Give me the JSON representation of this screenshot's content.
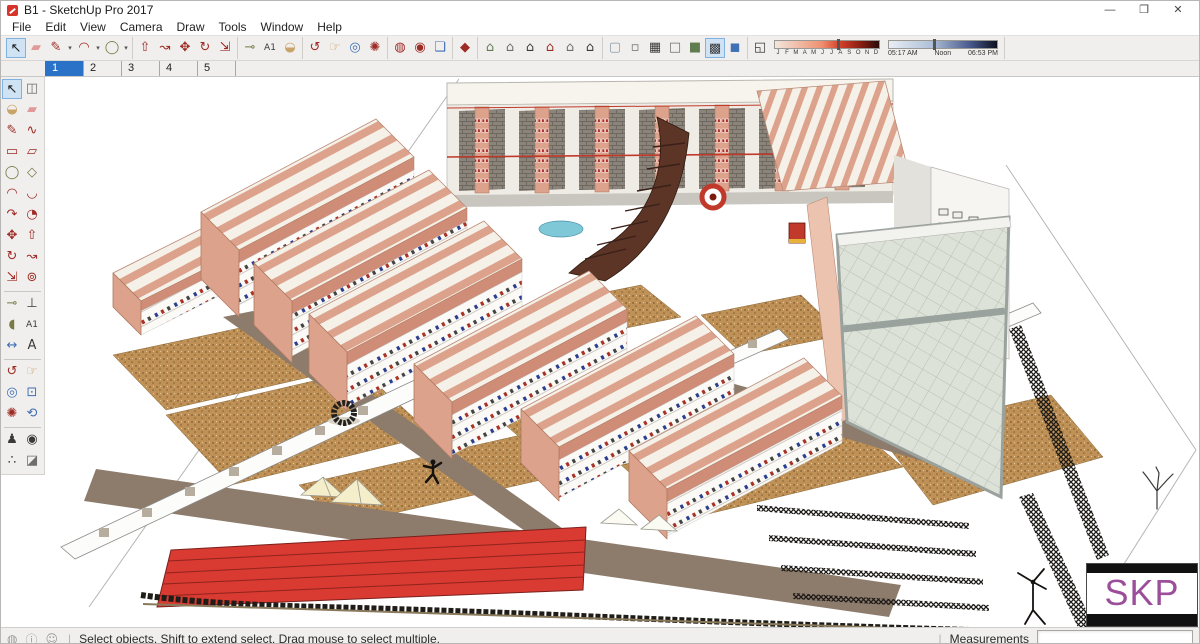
{
  "window": {
    "title": "B1 - SketchUp Pro 2017"
  },
  "menu": {
    "items": [
      "File",
      "Edit",
      "View",
      "Camera",
      "Draw",
      "Tools",
      "Window",
      "Help"
    ]
  },
  "icons": {
    "minimize": "—",
    "restore": "❐",
    "close": "✕",
    "dropdown": "▾",
    "select": "↖",
    "make_component": "◫",
    "paint_bucket": "◒",
    "eraser": "▰",
    "line": "✎",
    "freehand": "∿",
    "rectangle": "▭",
    "rotated_rectangle": "▱",
    "circle": "◯",
    "polygon": "◇",
    "arc": "◠",
    "arc2": "◡",
    "arc3": "↷",
    "pie": "◔",
    "move": "✥",
    "push_pull": "⇧",
    "rotate": "↻",
    "follow_me": "↝",
    "scale": "⇲",
    "offset": "⊚",
    "tape": "⊸",
    "axes": "⊥",
    "protractor": "◖",
    "text": "A1",
    "dimension": "↔",
    "text3d": "A",
    "orbit": "↺",
    "pan": "☞",
    "zoom": "◎",
    "zoom_window": "⊡",
    "zoom_extents": "✺",
    "previous": "⟲",
    "position_camera": "♟",
    "look_around": "◉",
    "walk": "∴",
    "section": "◪",
    "add_location": "◍",
    "toggle_terrain": "◉",
    "photo_textures": "❏",
    "warehouse": "◆",
    "view_iso": "⌂",
    "view_top": "⌂",
    "view_front": "⌂",
    "view_right": "⌂",
    "view_left": "⌂",
    "view_back": "⌂",
    "style_xray": "▢",
    "style_back_edges": "▫",
    "style_wireframe": "▦",
    "style_hidden": "□",
    "style_shaded": "■",
    "style_textured": "▩",
    "style_mono": "◼",
    "shadow_toggle": "◱",
    "geolocation": "◍",
    "credits": "ⓘ",
    "sign_in": "☺"
  },
  "shadows": {
    "months": [
      "J",
      "F",
      "M",
      "A",
      "M",
      "J",
      "J",
      "A",
      "S",
      "O",
      "N",
      "D"
    ],
    "start_time": "05:17 AM",
    "mid_time": "Noon",
    "end_time": "06:53 PM"
  },
  "scene_tabs": {
    "tabs": [
      "1",
      "2",
      "3",
      "4",
      "5"
    ],
    "active": "1"
  },
  "status_bar": {
    "hint": "Select objects. Shift to extend select. Drag mouse to select multiple.",
    "measurements_label": "Measurements",
    "measurements_value": ""
  },
  "watermark": {
    "text": "SKP"
  },
  "colors": {
    "accent": "#2a72c8",
    "sketchup_red": "#d7352a",
    "watermark_purple": "#9b4f9b",
    "wall_pink": "#dca28b",
    "fascia_pink": "#cf8d77",
    "roof_cream": "#f5f1e8",
    "ground_tan": "#bf9157",
    "path_taupe": "#8d7c6c",
    "track_red": "#d93a31",
    "tile_gray": "#dde2d8",
    "ramp_brown": "#5c3526",
    "railing_red": "#c0392b",
    "fleck_blue": "#2c3f8f",
    "fleck_red": "#a93226",
    "hedge_dark": "#201d18"
  }
}
